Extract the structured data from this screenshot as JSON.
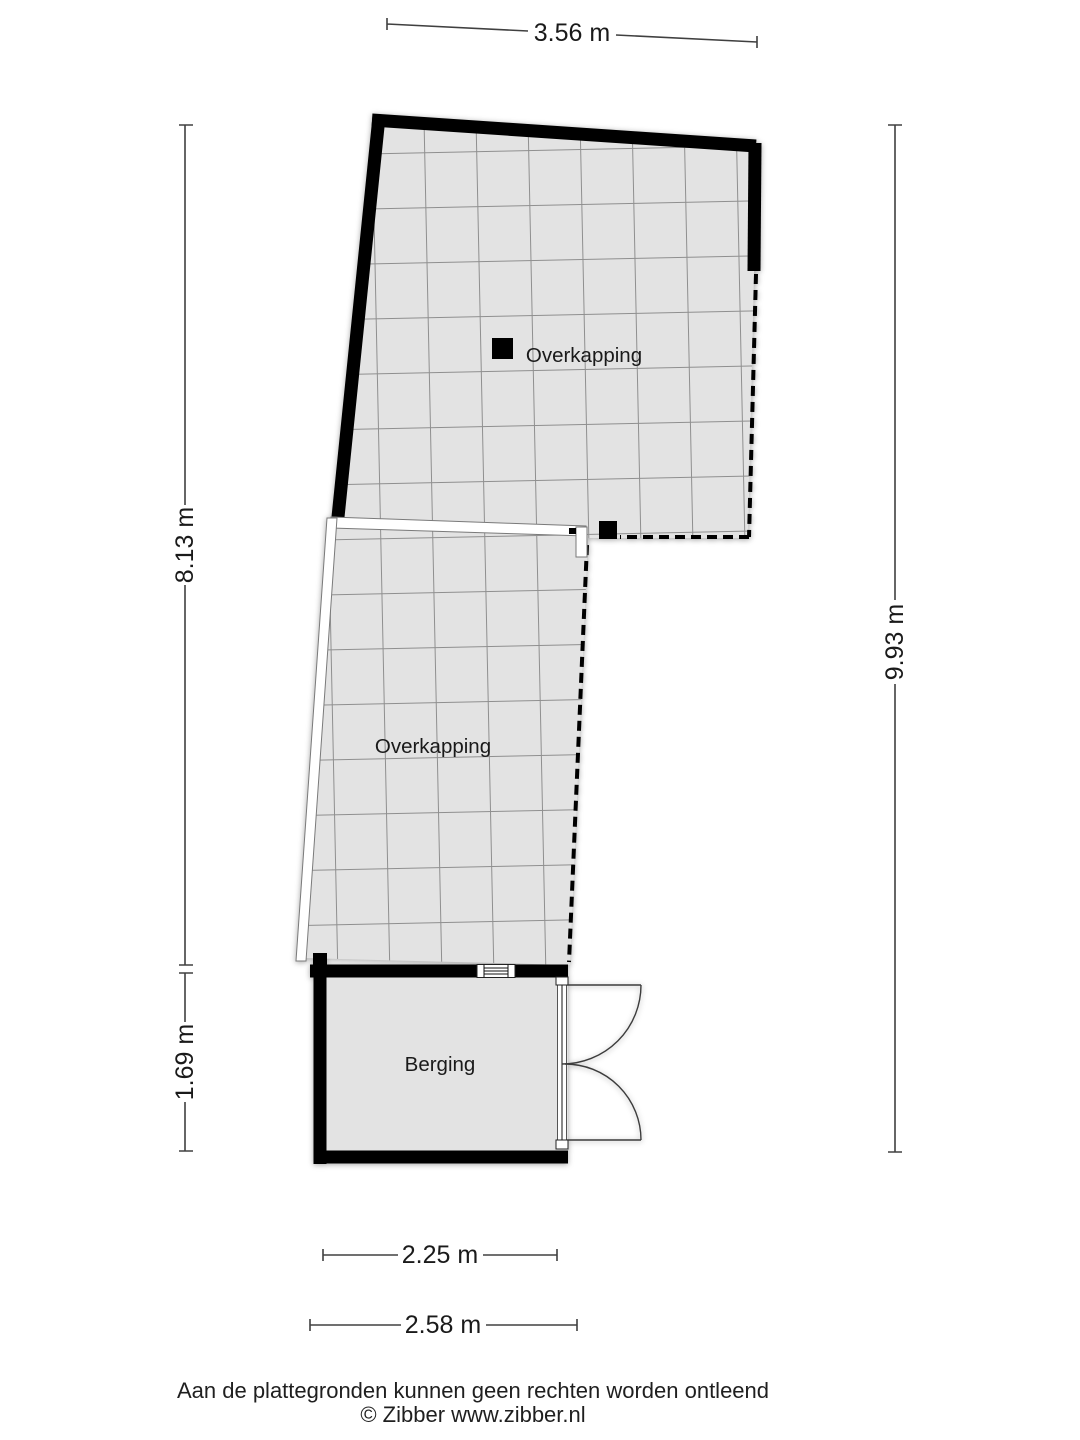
{
  "plan": {
    "rooms": [
      {
        "name": "overkapping-upper",
        "label": "Overkapping"
      },
      {
        "name": "overkapping-lower",
        "label": "Overkapping"
      },
      {
        "name": "berging",
        "label": "Berging"
      }
    ],
    "dimensions": [
      {
        "name": "top-width",
        "label": "3.56 m"
      },
      {
        "name": "left-height-upper",
        "label": "8.13 m"
      },
      {
        "name": "left-height-lower",
        "label": "1.69 m"
      },
      {
        "name": "right-height",
        "label": "9.93 m"
      },
      {
        "name": "bottom-width-inner",
        "label": "2.25 m"
      },
      {
        "name": "bottom-width-outer",
        "label": "2.58 m"
      }
    ]
  },
  "footer": {
    "disclaimer": "Aan de plattegronden kunnen geen rechten worden ontleend",
    "copyright": "© Zibber www.zibber.nl"
  },
  "colors": {
    "floor": "#e3e3e3",
    "grid": "#8f8f8f",
    "wall": "#000000",
    "dimension": "#404040",
    "text": "#1a1a1a"
  }
}
